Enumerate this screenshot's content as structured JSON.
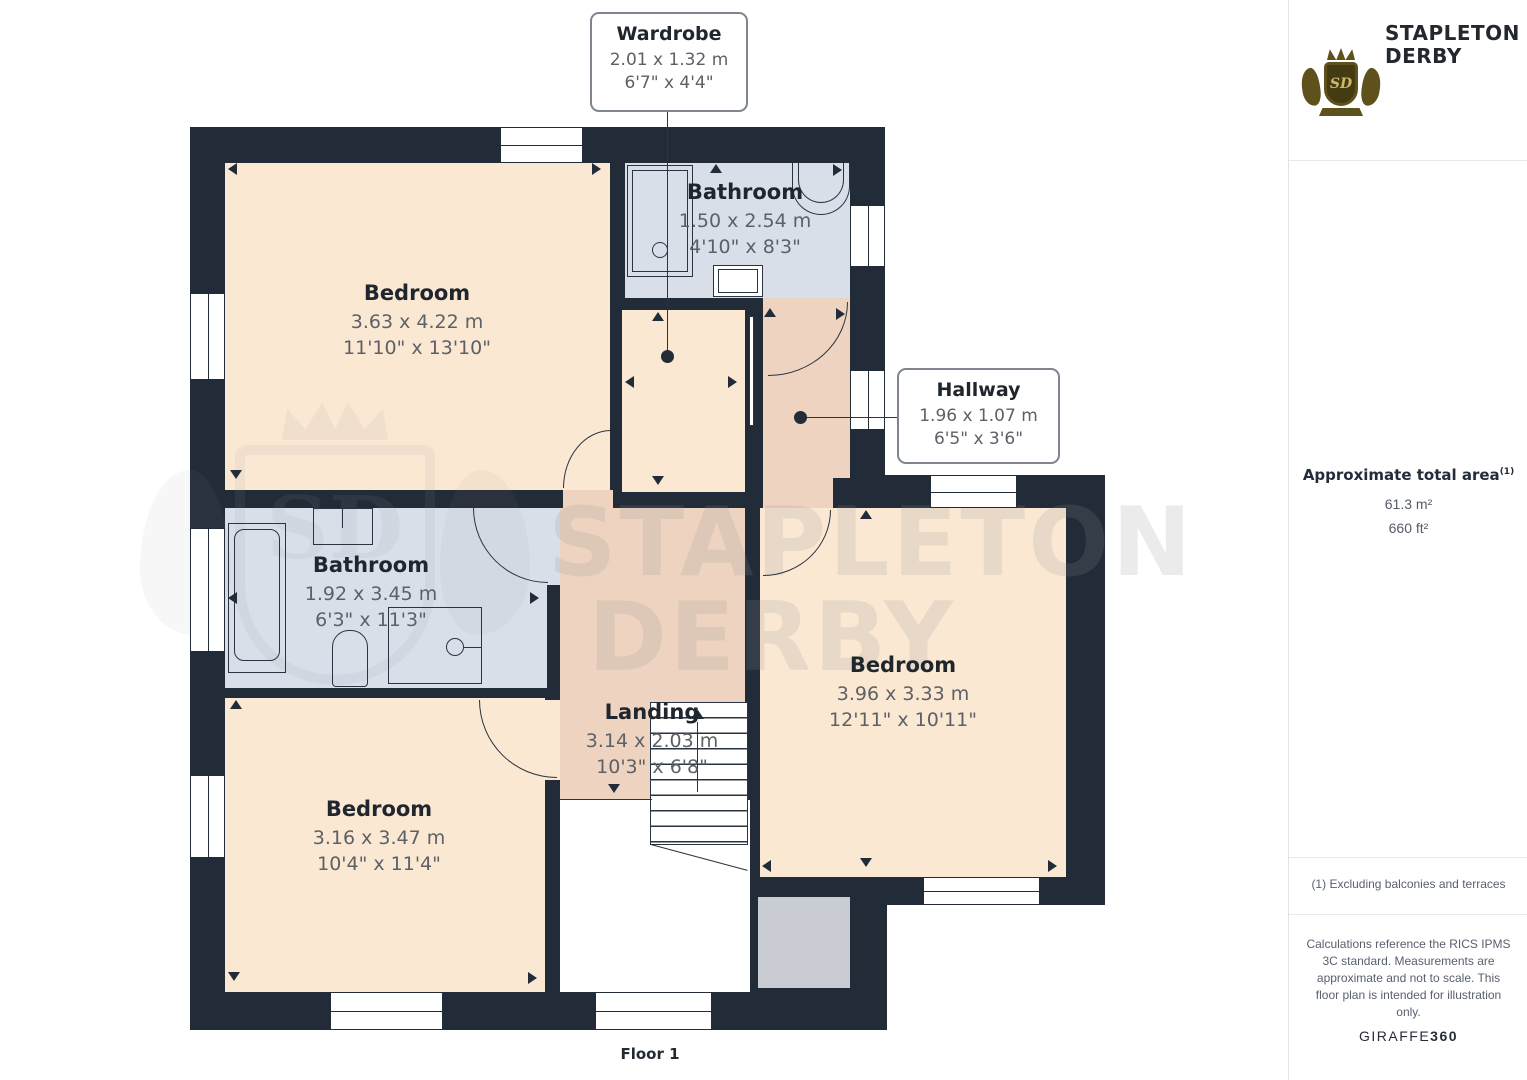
{
  "colors": {
    "wall": "#222c39",
    "bedroom": "#fbe8d3",
    "corridor": "#eed4c0",
    "bathroom": "#d9dfe9",
    "balcony": "#c9cdd3",
    "label_dark": "#20262e",
    "label_gray": "#5d6167",
    "logo_gold": "#5e511c"
  },
  "rooms": {
    "bedroom_top_left": {
      "name": "Bedroom",
      "metric": "3.63 x 4.22 m",
      "imperial": "11'10\" x 13'10\""
    },
    "bathroom_top": {
      "name": "Bathroom",
      "metric": "1.50 x 2.54 m",
      "imperial": "4'10\" x 8'3\""
    },
    "bathroom_mid": {
      "name": "Bathroom",
      "metric": "1.92 x 3.45 m",
      "imperial": "6'3\" x 11'3\""
    },
    "landing": {
      "name": "Landing",
      "metric": "3.14 x 2.03 m",
      "imperial": "10'3\" x 6'8\""
    },
    "bedroom_right": {
      "name": "Bedroom",
      "metric": "3.96 x 3.33 m",
      "imperial": "12'11\" x 10'11\""
    },
    "bedroom_bottom_left": {
      "name": "Bedroom",
      "metric": "3.16 x 3.47 m",
      "imperial": "10'4\" x 11'4\""
    }
  },
  "callouts": {
    "wardrobe": {
      "name": "Wardrobe",
      "metric": "2.01 x 1.32 m",
      "imperial": "6'7\" x 4'4\""
    },
    "hallway": {
      "name": "Hallway",
      "metric": "1.96 x 1.07 m",
      "imperial": "6'5\" x 3'6\""
    }
  },
  "floor_label": "Floor 1",
  "watermark": {
    "line1": "STAPLETON",
    "line2": "DERBY",
    "monogram": "SD"
  },
  "brand": {
    "monogram": "SD",
    "line1": "STAPLETON",
    "line2": "DERBY"
  },
  "sidebar": {
    "area_title": "Approximate total area",
    "area_marker": "(1)",
    "area_metric": "61.3 m²",
    "area_imperial": "660 ft²",
    "footnote": "(1) Excluding balconies and terraces",
    "disclaimer": "Calculations reference the RICS IPMS 3C standard. Measurements are approximate and not to scale. This floor plan is intended for illustration only.",
    "credit_name": "GIRAFFE",
    "credit_suffix": "360"
  }
}
